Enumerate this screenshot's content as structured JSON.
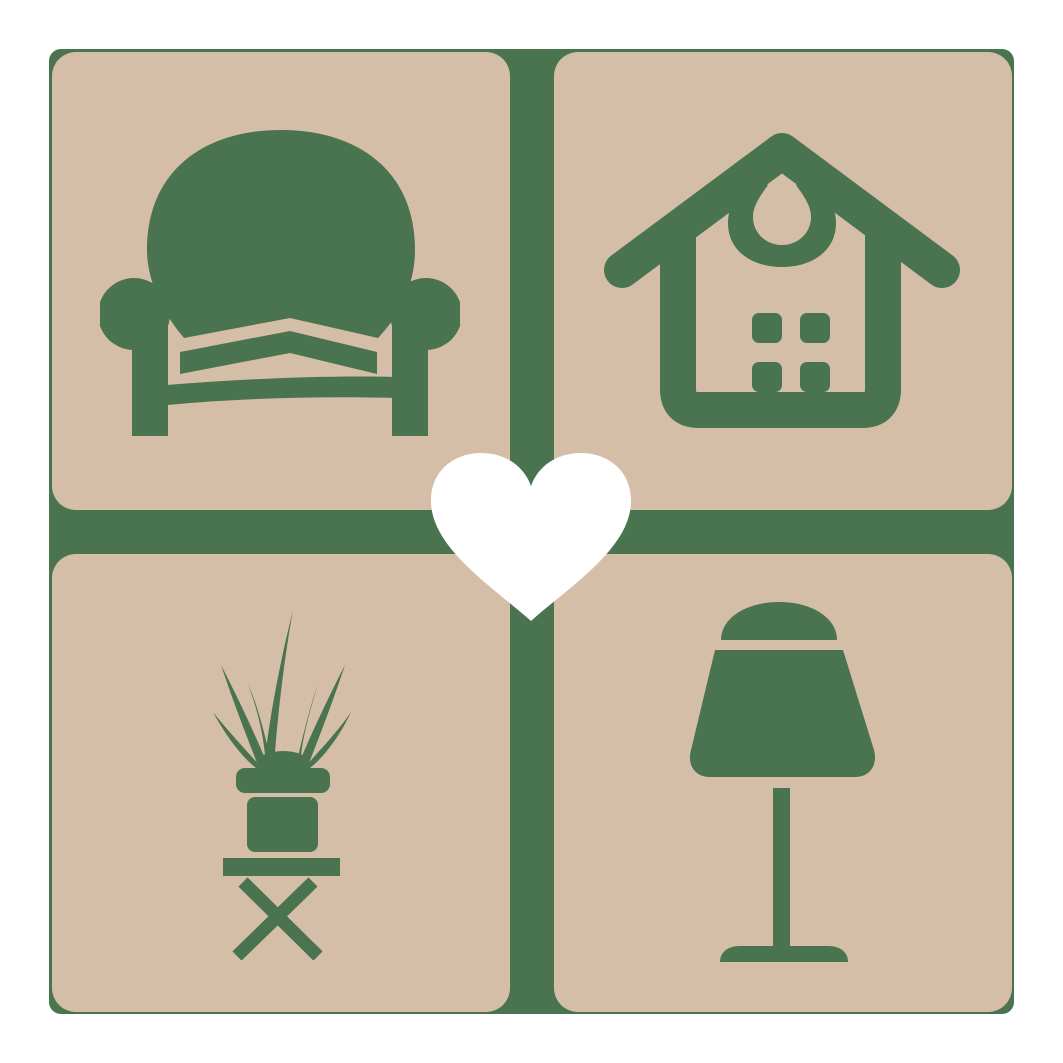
{
  "logo": {
    "description": "Square home-decor logo: four beige rounded tiles with green furniture icons separated by a green cross, white heart at center",
    "colors": {
      "tileBeige": "#d5bea8",
      "accentGreen": "#4a7350",
      "heartWhite": "#ffffff",
      "pageWhite": "#ffffff"
    },
    "tiles": [
      {
        "position": "top-left",
        "icon": "armchair-icon",
        "label": "armchair"
      },
      {
        "position": "top-right",
        "icon": "house-icon",
        "label": "house"
      },
      {
        "position": "bottom-left",
        "icon": "potted-plant-icon",
        "label": "potted plant on stool"
      },
      {
        "position": "bottom-right",
        "icon": "table-lamp-icon",
        "label": "table lamp"
      }
    ],
    "center": {
      "icon": "heart-icon",
      "label": "heart"
    }
  }
}
